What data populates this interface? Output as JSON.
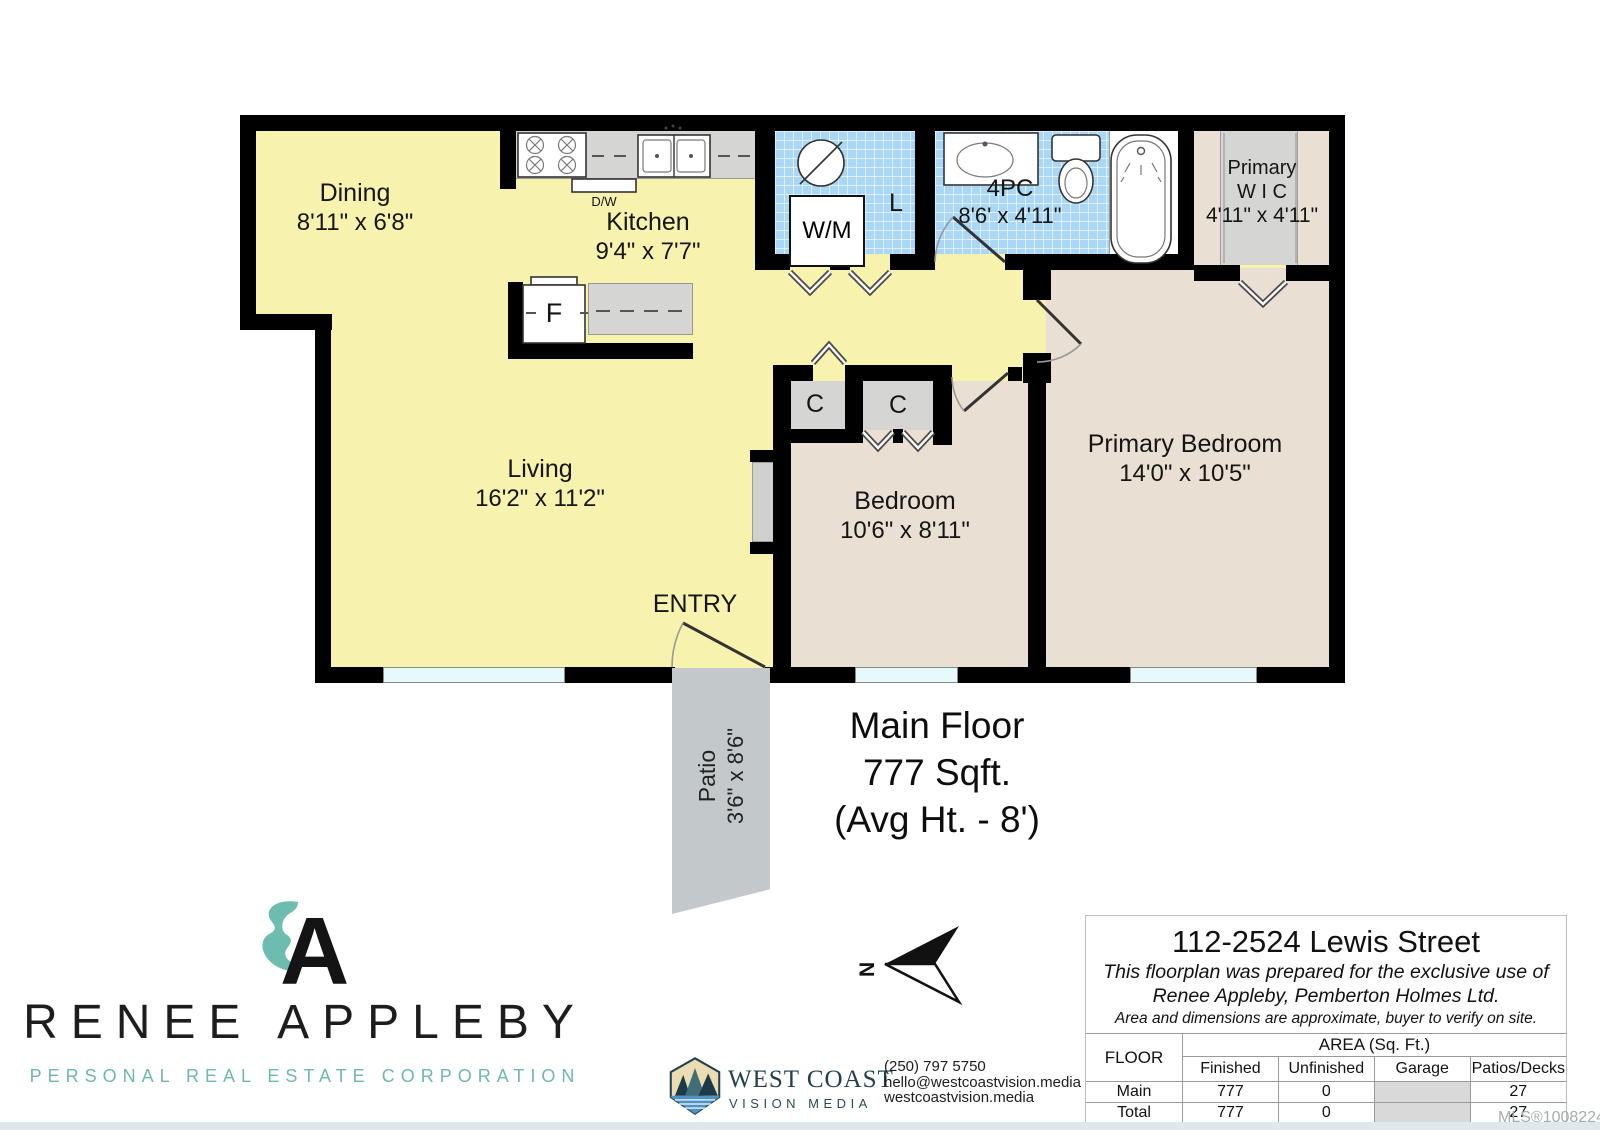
{
  "plan": {
    "rooms": {
      "dining": {
        "name": "Dining",
        "dims": "8'11\" x 6'8\""
      },
      "kitchen": {
        "name": "Kitchen",
        "dims": "9'4\" x 7'7\""
      },
      "living": {
        "name": "Living",
        "dims": "16'2\" x 11'2\""
      },
      "laundry": {
        "label": "L"
      },
      "washer": {
        "label": "W/M"
      },
      "dishwasher": {
        "label": "D/W"
      },
      "fridge": {
        "label": "F"
      },
      "bath": {
        "name": "4PC",
        "dims": "8'6' x 4'11\""
      },
      "wic": {
        "line1": "Primary",
        "line2": "W I C",
        "dims": "4'11\" x 4'11\""
      },
      "bedroom": {
        "name": "Bedroom",
        "dims": "10'6\" x 8'11\""
      },
      "primary_bedroom": {
        "name": "Primary Bedroom",
        "dims": "14'0\" x 10'5\""
      },
      "closet_left": {
        "label": "C"
      },
      "closet_right": {
        "label": "C"
      },
      "entry": {
        "label": "ENTRY"
      },
      "patio": {
        "name": "Patio",
        "dims": "3'6\" x 8'6\""
      }
    },
    "summary": {
      "line1": "Main Floor",
      "line2": "777 Sqft.",
      "line3": "(Avg Ht. - 8')"
    },
    "compass_n": "N"
  },
  "agent_logo": {
    "name": "RENEE APPLEBY",
    "tagline": "PERSONAL REAL ESTATE CORPORATION",
    "teal": "#6CBCB0",
    "black": "#141414"
  },
  "media_logo": {
    "line1": "WEST COAST",
    "line2": "VISION MEDIA",
    "phone": "(250) 797 5750",
    "email": "hello@westcoastvision.media",
    "website": "westcoastvision.media"
  },
  "info_box": {
    "address": "112-2524 Lewis Street",
    "disclaimer1": "This floorplan was prepared for the exclusive use of",
    "disclaimer2": "Renee Appleby, Pemberton Holmes Ltd.",
    "disclaimer3": "Area and dimensions are approximate, buyer to verify on site.",
    "table": {
      "floor_header": "FLOOR",
      "area_header": "AREA (Sq. Ft.)",
      "columns": [
        "Finished",
        "Unfinished",
        "Garage",
        "Patios/Decks"
      ],
      "rows": [
        {
          "floor": "Main",
          "finished": "777",
          "unfinished": "0",
          "garage": "",
          "patios": "27"
        },
        {
          "floor": "Total",
          "finished": "777",
          "unfinished": "0",
          "garage": "",
          "patios": "27"
        }
      ]
    }
  },
  "watermark": "MLS®1008224",
  "colors": {
    "room_yellow": "#F7F2AE",
    "room_beige": "#EADFD3",
    "tile_blue": "#ABD7F6",
    "closet_gray": "#D5D5D3",
    "patio_gray": "#C3C9CB",
    "window_cyan": "#E6FAFC",
    "wall_black": "#000000"
  }
}
